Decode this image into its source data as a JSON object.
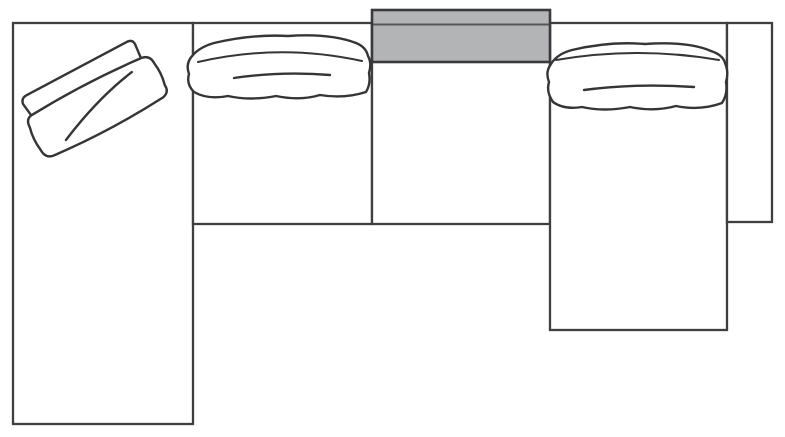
{
  "diagram": {
    "name": "sectional-sofa-floor-plan",
    "canvas": {
      "width": 785,
      "height": 437
    },
    "colors": {
      "background": "#ffffff",
      "outline": "#3f3f41",
      "sketch": "#353537",
      "console_fill": "#b3b4b6",
      "console_border": "#3a3a3c"
    },
    "sections": [
      {
        "name": "left-chaise",
        "x": 13,
        "y": 23,
        "width": 180,
        "height": 401
      },
      {
        "name": "armless-seat",
        "x": 193,
        "y": 23,
        "width": 179,
        "height": 201
      },
      {
        "name": "console-seat",
        "x": 372,
        "y": 23,
        "width": 178,
        "height": 201
      },
      {
        "name": "right-chaise",
        "x": 550,
        "y": 23,
        "width": 177,
        "height": 307
      },
      {
        "name": "right-armrest",
        "x": 727,
        "y": 23,
        "width": 45,
        "height": 199
      }
    ],
    "console": {
      "name": "console-table",
      "x": 372,
      "y": 10,
      "width": 178,
      "height": 52
    },
    "cushions": [
      {
        "name": "left-chaise-pillow",
        "section": "left-chaise"
      },
      {
        "name": "armless-seat-cushion",
        "section": "armless-seat"
      },
      {
        "name": "right-chaise-cushion",
        "section": "right-chaise"
      }
    ]
  }
}
